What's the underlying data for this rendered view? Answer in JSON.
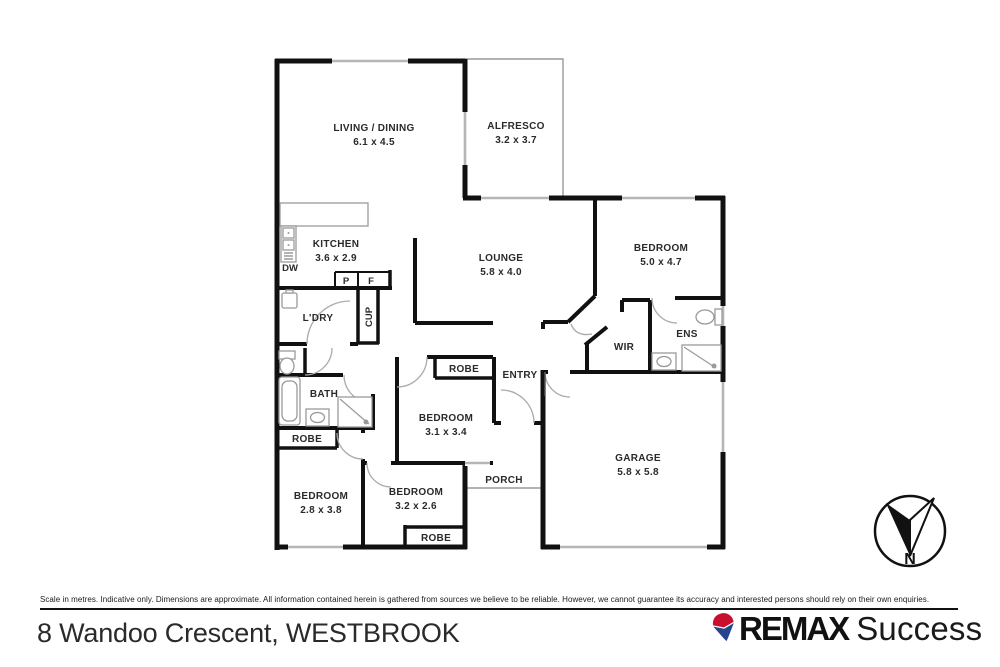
{
  "floorplan": {
    "rooms": {
      "living": {
        "label": "LIVING / DINING",
        "dims": "6.1 x 4.5"
      },
      "alfresco": {
        "label": "ALFRESCO",
        "dims": "3.2 x 3.7"
      },
      "kitchen": {
        "label": "KITCHEN",
        "dims": "3.6 x 2.9"
      },
      "lounge": {
        "label": "LOUNGE",
        "dims": "5.8 x 4.0"
      },
      "bed_master": {
        "label": "BEDROOM",
        "dims": "5.0 x 4.7"
      },
      "bed2": {
        "label": "BEDROOM",
        "dims": "3.1 x 3.4"
      },
      "bed3": {
        "label": "BEDROOM",
        "dims": "2.8 x 3.8"
      },
      "bed4": {
        "label": "BEDROOM",
        "dims": "3.2 x 2.6"
      },
      "garage": {
        "label": "GARAGE",
        "dims": "5.8 x 5.8"
      },
      "laundry": {
        "label": "L'DRY"
      },
      "cupboard": {
        "label": "CUP"
      },
      "bath": {
        "label": "BATH"
      },
      "wir": {
        "label": "WIR"
      },
      "ens": {
        "label": "ENS"
      },
      "entry": {
        "label": "ENTRY"
      },
      "porch": {
        "label": "PORCH"
      },
      "robe": {
        "label": "ROBE"
      }
    },
    "fixtures": {
      "dishwasher": "DW",
      "pantry": "P",
      "fridge": "F"
    },
    "compass": {
      "north": "N"
    }
  },
  "footer": {
    "disclaimer": "Scale in metres. Indicative only. Dimensions are approximate. All information contained herein is gathered from sources we believe to be reliable. However, we cannot guarantee its accuracy and interested persons should rely on their own enquiries.",
    "address": "8 Wandoo Crescent, WESTBROOK"
  },
  "brand": {
    "name": "REMAX",
    "suffix": "Success",
    "balloon_red": "#c8102e",
    "balloon_blue": "#28458c"
  }
}
